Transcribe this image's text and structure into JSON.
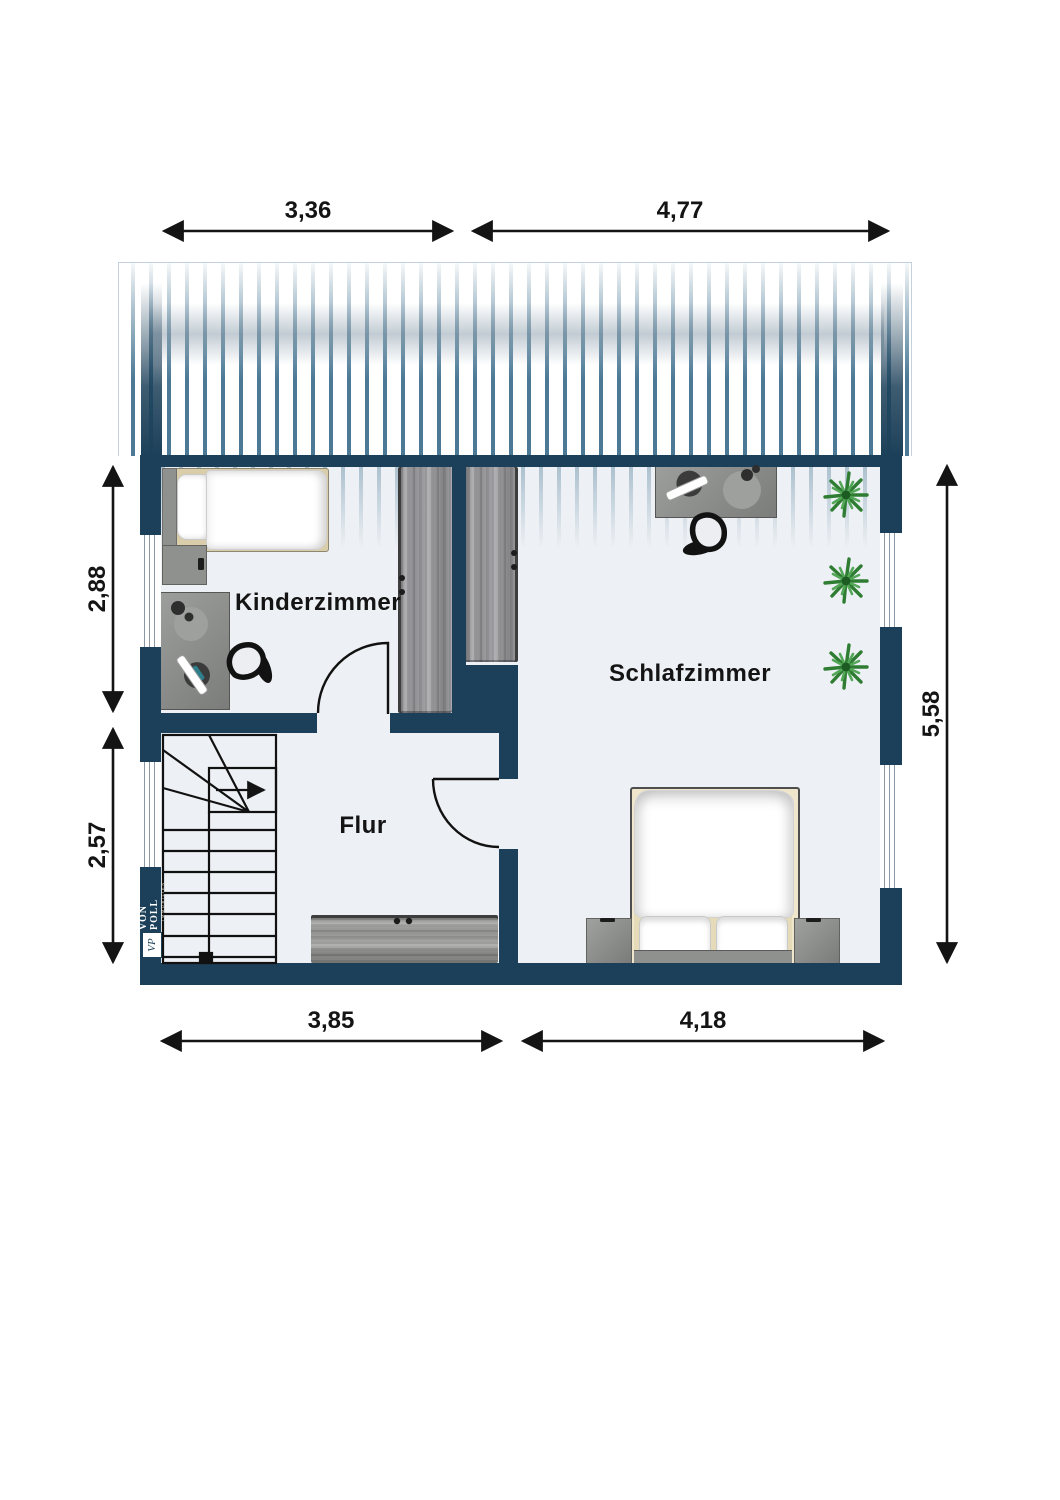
{
  "brand": {
    "name": "VON POLL",
    "sub": "IMMOBILIEN",
    "monogram": "VP"
  },
  "rooms": [
    {
      "name": "Kinderzimmer"
    },
    {
      "name": "Schlafzimmer"
    },
    {
      "name": "Flur"
    }
  ],
  "dimensions": {
    "top": [
      "3,36",
      "4,77"
    ],
    "left": [
      "2,88",
      "2,57"
    ],
    "right": [
      "5,58"
    ],
    "bottom": [
      "3,85",
      "4,18"
    ]
  },
  "furniture": [
    "single-bed",
    "nightstand",
    "desk",
    "desk-chair",
    "wardrobe-kinderzimmer",
    "wardrobe-schlafzimmer",
    "desk-schlafzimmer",
    "desk-chair-schlafzimmer",
    "plant",
    "plant",
    "plant",
    "double-bed",
    "nightstand-left",
    "nightstand-right",
    "sideboard",
    "winder-staircase"
  ],
  "colors": {
    "wall": "#1c4059",
    "roof_hatch": "#4c7a96",
    "floor": "#edf0f4",
    "wood": "#90908e",
    "bed_beige": "#d9cdaa",
    "plant": "#2f7d33",
    "dimension_text": "#141414"
  }
}
